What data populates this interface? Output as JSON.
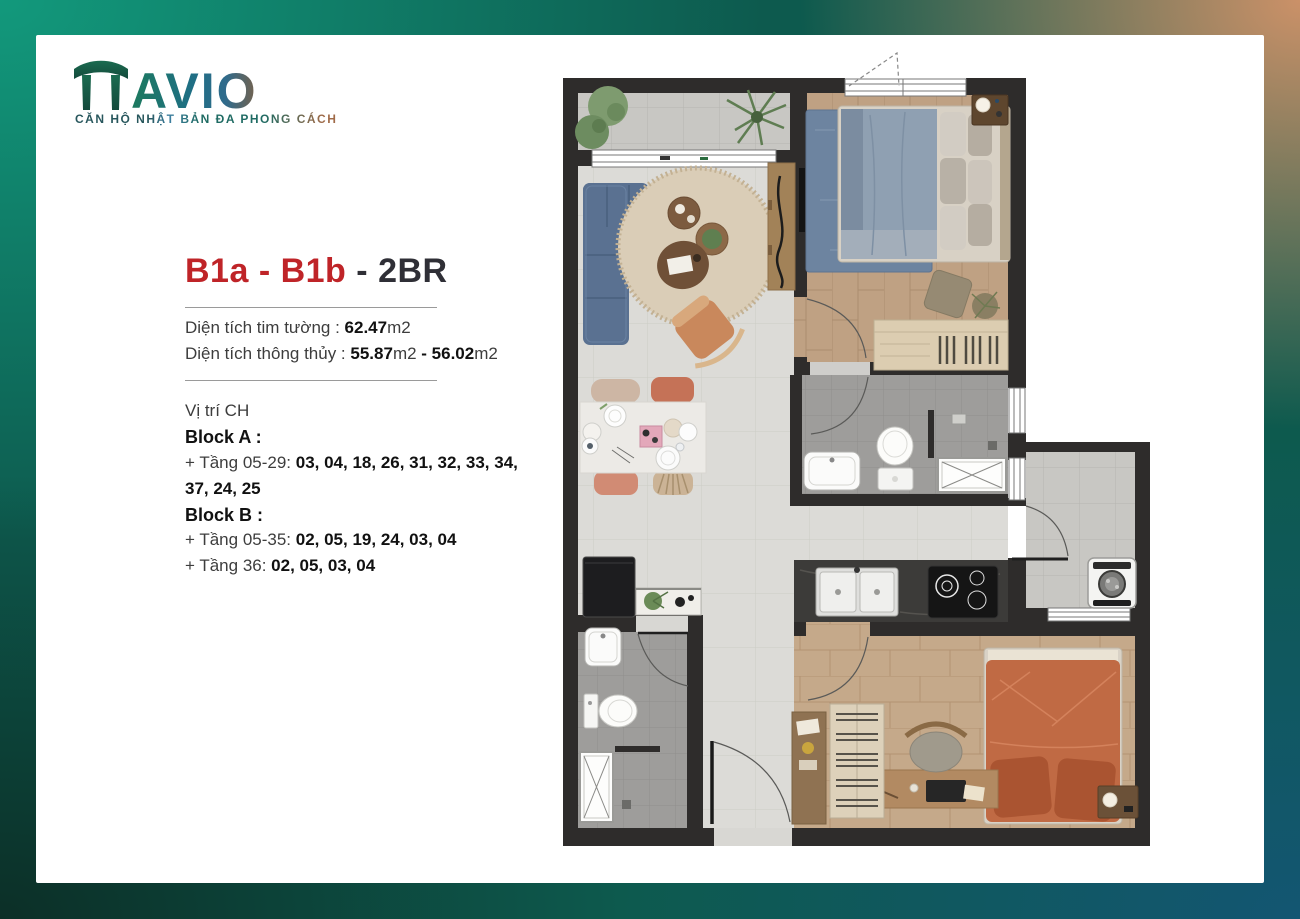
{
  "page": {
    "background_corners": {
      "top_left": "#12997c",
      "top_right": "#cb9168",
      "bottom_left": "#0c2f27",
      "bottom_right": "#135672",
      "base": "#0d5a4e"
    },
    "card_bg": "#ffffff"
  },
  "logo": {
    "brand": "AVIO",
    "tagline": "CĂN HỘ NHẬT BẢN ĐA PHONG CÁCH",
    "icon": "torii-gate-icon",
    "gradient": [
      "#1d7a5e",
      "#1e6f83",
      "#a87c57"
    ]
  },
  "unit": {
    "code": "B1a - B1b",
    "separator": "-",
    "type": "2BR",
    "accent_color": "#bf2428",
    "gross_label": "Diện tích tim tường : ",
    "gross_value": "62.47",
    "gross_unit": "m2",
    "net_label": "Diện tích thông thủy : ",
    "net_value_min": "55.87",
    "net_unit_min": "m2 ",
    "net_value_max": "- 56.02",
    "net_unit_max": "m2"
  },
  "location": {
    "heading": "Vị trí CH",
    "block_a_title": "Block A :",
    "block_a_line1_prefix": "+ Tầng 05-29: ",
    "block_a_line1_units": "03, 04, 18, 26, 31, 32, 33, 34,",
    "block_a_line2_units": "37, 24, 25",
    "block_b_title": "Block B :",
    "block_b_line1_prefix": "+ Tầng 05-35: ",
    "block_b_line1_units": "02, 05, 19, 24, 03, 04",
    "block_b_line2_prefix": "+ Tầng 36: ",
    "block_b_line2_units": "02, 05, 03, 04"
  },
  "floorplan": {
    "rooms": [
      "balcony",
      "living-room",
      "dining-area",
      "master-bedroom",
      "ensuite-bathroom",
      "hall",
      "kitchen",
      "laundry-balcony",
      "second-bedroom",
      "second-bathroom",
      "entry"
    ],
    "fixtures": [
      "sofa",
      "round-rug",
      "coffee-tables",
      "armchair",
      "tv-console",
      "dining-table",
      "fridge",
      "plant-console",
      "sink",
      "toilet",
      "shower",
      "bed-blue",
      "blue-rug",
      "nightstand",
      "ottoman",
      "dresser",
      "washing-machine",
      "kitchen-sink",
      "induction-hob",
      "bed-orange",
      "desk",
      "desk-chair",
      "wardrobe",
      "bookshelf",
      "palm-plant",
      "shrub-plants"
    ],
    "colors": {
      "wall": "#2e2c2b",
      "tile_light": "#dcdbd7",
      "tile_balcony": "#c8c7c3",
      "tile_bath": "#9e9d9b",
      "wood_master": "#bfa183",
      "wood_second": "#c5a98a",
      "sofa_blue": "#5a7191",
      "bed_blue": "#8fa0b2",
      "rug_blue": "#6d84a0",
      "rug_beige": "#dacdb7",
      "bed_orange": "#c06a44",
      "counter_dark": "#3c3b39"
    }
  }
}
